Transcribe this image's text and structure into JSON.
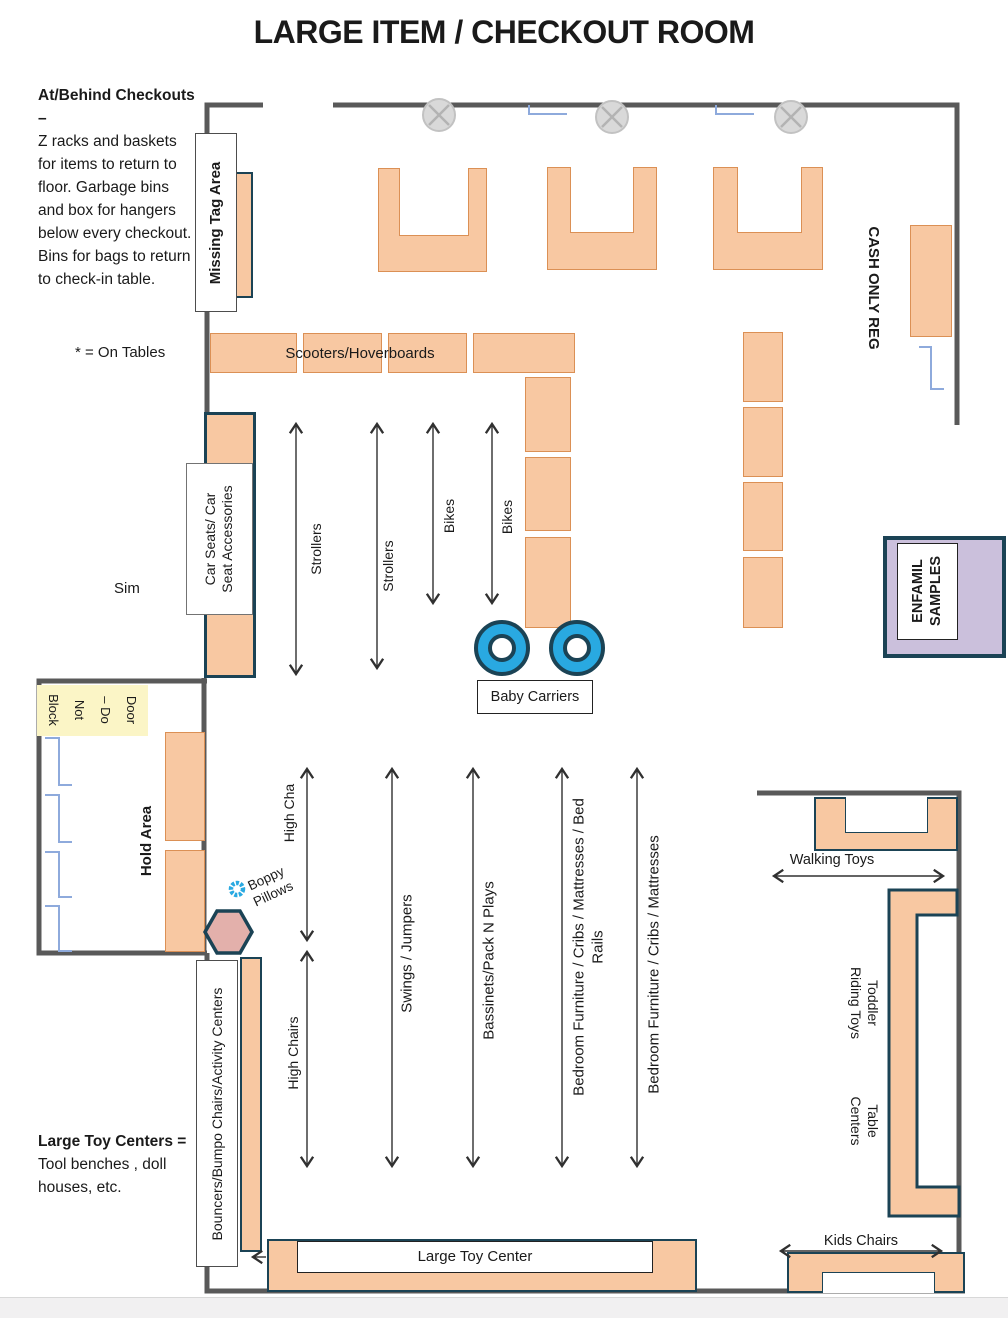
{
  "title": "LARGE ITEM / CHECKOUT ROOM",
  "notes": {
    "checkout_heading": "At/Behind Checkouts –",
    "checkout_body": "Z racks and baskets for items to return to floor. Garbage bins and box for hangers below every checkout. Bins for bags to return to check-in table.",
    "on_tables": "* = On Tables",
    "sim": "Sim",
    "large_toy_heading": "Large Toy Centers =",
    "large_toy_body": "Tool benches , doll houses, etc."
  },
  "areas": {
    "missing_tag": "Missing Tag Area",
    "cash_only_reg": "CASH ONLY REG",
    "scooters": "Scooters/Hoverboards",
    "car_seats": {
      "line1": "Car Seats/ Car",
      "line2": "Seat Accessories"
    },
    "enfamil": {
      "line1": "ENFAMIL",
      "line2": "SAMPLES"
    },
    "baby_carriers": "Baby Carriers",
    "door": {
      "line1": "Door",
      "line2": "– Do",
      "line3": "Not",
      "line4": "Block"
    },
    "hold_area": "Hold Area",
    "boppy": {
      "line1": "Boppy",
      "line2": "Pillows"
    },
    "bouncers": "Bouncers/Bumpo Chairs/Activity Centers",
    "walking_toys": "Walking Toys",
    "toddler": {
      "line1": "Toddler",
      "line2": "Riding Toys"
    },
    "table_centers": {
      "line1": "Table",
      "line2": "Centers"
    },
    "kids_chairs": "Kids Chairs",
    "large_toy_center": "Large Toy Center"
  },
  "aisles": {
    "strollers_1": "Strollers",
    "strollers_2": "Strollers",
    "bikes_1": "Bikes",
    "bikes_2": "Bikes",
    "high_cha": "High Cha",
    "high_chairs": "High Chairs",
    "swings": "Swings / Jumpers",
    "bassinets": "Bassinets/Pack N Plays",
    "bedroom_1": {
      "line1": "Bedroom Furniture / Cribs / Mattresses / Bed",
      "line2": "Rails"
    },
    "bedroom_2": "Bedroom Furniture / Cribs / Mattresses"
  },
  "colors": {
    "table_fill": "#F8C8A2",
    "table_border": "#DB9055",
    "navy_border": "#1B4355",
    "wall_gray": "#595959",
    "bracket_blue": "#8EAADC",
    "wheel_blue": "#29A9E1",
    "enfamil_purple": "#CBC0DC",
    "door_yellow": "#FBF5C6",
    "hexagon_pink": "#E3B0AB",
    "light_gray": "#D9D9D9"
  }
}
